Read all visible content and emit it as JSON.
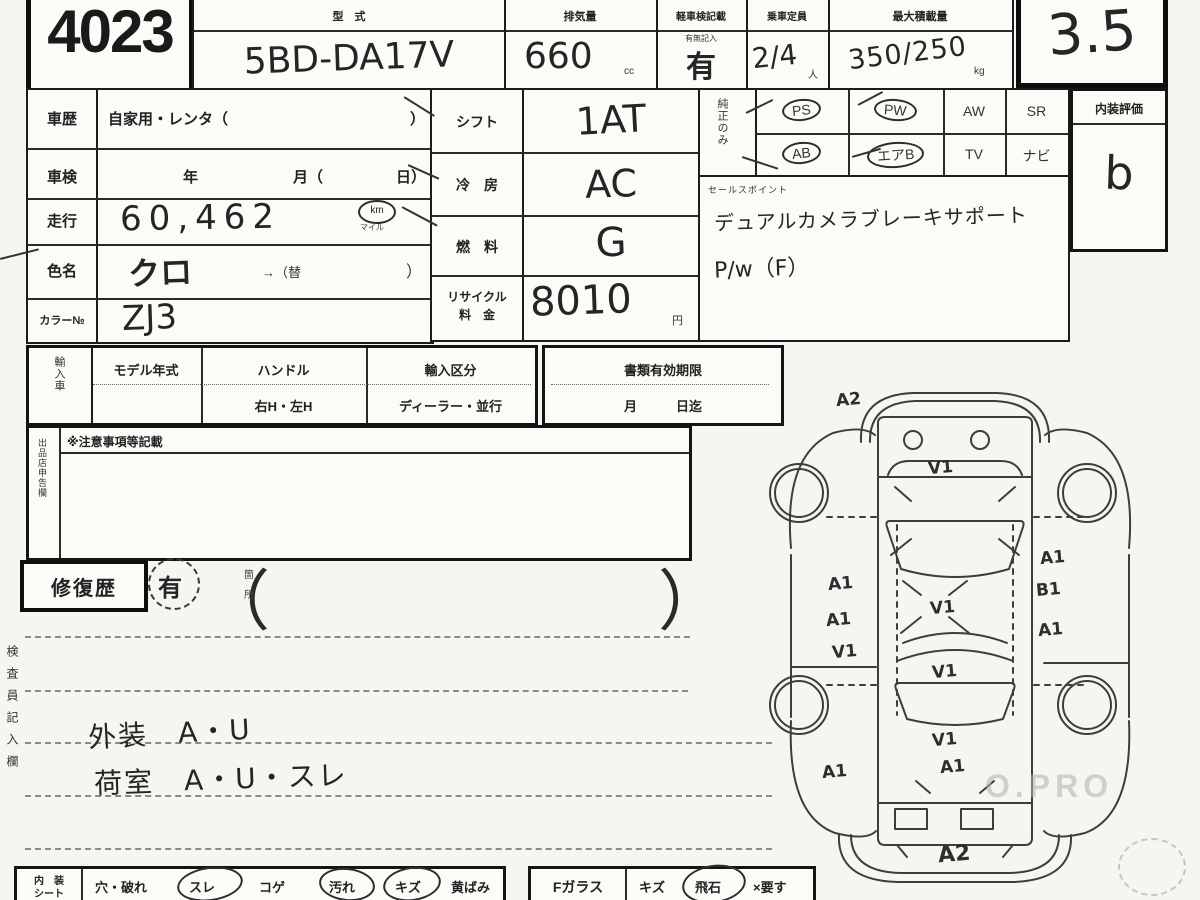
{
  "lot_number": "4023",
  "grade": "3.5",
  "top": {
    "model_label": "型　式",
    "model_value": "5BD-DA17V",
    "disp_label": "排気量",
    "disp_value": "660",
    "disp_unit": "cc",
    "doc_label": "軽車検記載",
    "doc_note": "有無記入",
    "doc_value": "有",
    "cap_label": "乗車定員",
    "cap_value": "2/4",
    "cap_unit": "人",
    "load_label": "最大積載量",
    "load_value": "350/250",
    "load_unit": "kg"
  },
  "left_info": {
    "history_label": "車歴",
    "history_value": "自家用・レンタ（",
    "history_close": "）",
    "shaken_label": "車検",
    "shaken_y": "年",
    "shaken_m": "月（",
    "shaken_d": "日）",
    "mileage_label": "走行",
    "mileage_value": "60,462",
    "mileage_unit": "km",
    "mileage_unit_sub": "マイル",
    "color_label": "色名",
    "color_value": "クロ",
    "color_suffix": "→（替",
    "color_close": "）",
    "colorno_label": "カラー№",
    "colorno_value": "ZJ3"
  },
  "mid_info": {
    "shift_label": "シフト",
    "shift_value": "1AT",
    "ac_label": "冷　房",
    "ac_value": "AC",
    "fuel_label": "燃　料",
    "fuel_value": "G",
    "recycle_label1": "リサイクル",
    "recycle_label2": "料　金",
    "recycle_value": "8010",
    "recycle_unit": "円"
  },
  "equipment": {
    "side_label": "純正のみ",
    "items": [
      {
        "label": "PS",
        "circled": true
      },
      {
        "label": "PW",
        "circled": true
      },
      {
        "label": "AW",
        "circled": false
      },
      {
        "label": "SR",
        "circled": false
      },
      {
        "label": "AB",
        "circled": true
      },
      {
        "label": "エアB",
        "circled": true
      },
      {
        "label": "TV",
        "circled": false
      },
      {
        "label": "ナビ",
        "circled": false
      }
    ]
  },
  "sales_point": {
    "label": "セールスポイント",
    "line1": "デュアルカメラブレーキサポート",
    "line2": "P/w（F）"
  },
  "interior_eval": {
    "label": "内装評価",
    "value": "b"
  },
  "import_row": {
    "side_label": "輸入車",
    "model_year_label": "モデル年式",
    "handle_label": "ハンドル",
    "handle_options": "右H・左H",
    "type_label": "輸入区分",
    "type_options": "ディーラー・並行",
    "docs_label": "書類有効期限",
    "docs_options": "月　　　日迄"
  },
  "notes": {
    "side_label": "出品店申告欄",
    "header": "※注意事項等記載"
  },
  "repair": {
    "label": "修復歴",
    "value": "有",
    "paren_note1": "箇",
    "paren_note2": "所"
  },
  "inspector": {
    "side_label": "検査員記入欄",
    "line1": "外装　A・U",
    "line2": "荷室　A・U・スレ"
  },
  "bottom_row": {
    "seat_label1": "内　装",
    "seat_label2": "シート",
    "seat_items": [
      {
        "label": "穴・破れ",
        "circled": false
      },
      {
        "label": "スレ",
        "circled": true
      },
      {
        "label": "コゲ",
        "circled": false
      },
      {
        "label": "汚れ",
        "circled": true
      },
      {
        "label": "キズ",
        "circled": true
      },
      {
        "label": "黄ばみ",
        "circled": false
      }
    ],
    "glass_label": "Fガラス",
    "glass_items": [
      {
        "label": "キズ",
        "circled": false
      },
      {
        "label": "飛石",
        "circled": true
      },
      {
        "label": "×要す",
        "circled": false
      }
    ]
  },
  "diagram": {
    "annotations": [
      {
        "text": "A2"
      },
      {
        "text": "V1"
      },
      {
        "text": "A1"
      },
      {
        "text": "A1"
      },
      {
        "text": "B1"
      },
      {
        "text": "A1"
      },
      {
        "text": "V1"
      },
      {
        "text": "V1"
      },
      {
        "text": "A1"
      },
      {
        "text": "V1"
      },
      {
        "text": "V1"
      },
      {
        "text": "A1"
      },
      {
        "text": "A1"
      },
      {
        "text": "A2"
      }
    ]
  },
  "watermark": "O.PRO"
}
